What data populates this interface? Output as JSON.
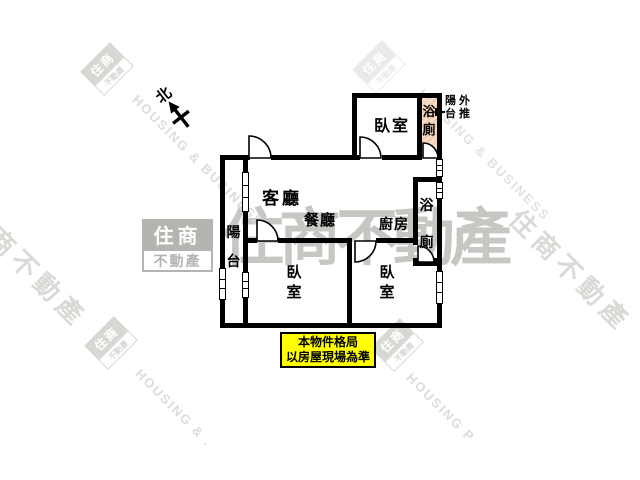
{
  "plan": {
    "north_label": "北",
    "labels": {
      "living": "客廳",
      "dining": "餐廳",
      "kitchen": "廚房",
      "bedroom_top": "臥室",
      "bedroom_left": "臥室",
      "bedroom_right": "臥室",
      "bath_top": "浴廁",
      "bath_mid": "浴廁",
      "balcony": "陽台"
    },
    "pushout_note": {
      "row1": "陽外",
      "row2": "台推"
    },
    "disclaimer": {
      "line1": "本物件格局",
      "line2": "以房屋現場為準"
    }
  },
  "watermarks": {
    "logo_top_text": "住商",
    "logo_bottom_text": "不動產",
    "brand_text": "住商不動產",
    "en_text": "HOUSING & BUSINESS",
    "en_partial_left": "HOUSING & .",
    "en_partial_right": "HOUSING P"
  },
  "colors": {
    "bath_fill": "#f6dcc8",
    "note_bg": "#ffff00",
    "brand_gray": "#c6c6c3",
    "light_gray": "#dcdcda"
  }
}
